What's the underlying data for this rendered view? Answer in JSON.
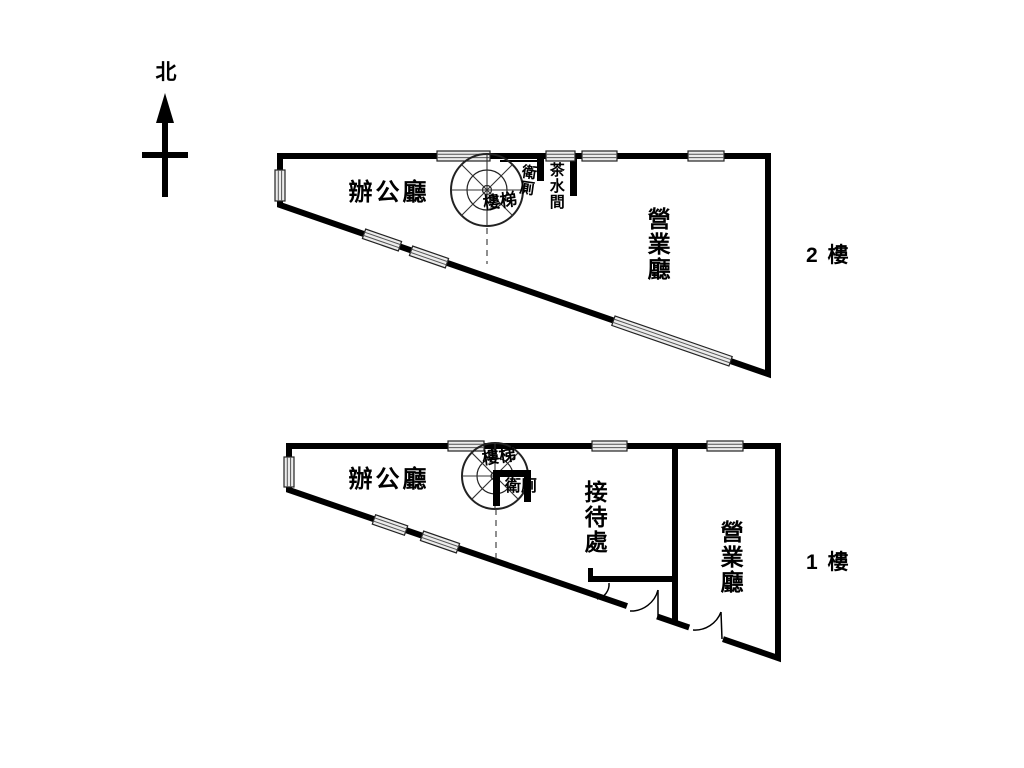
{
  "compass": {
    "north_label": "北"
  },
  "colors": {
    "line": "#000000",
    "window_fill": "#ececec",
    "background": "#ffffff"
  },
  "floors": [
    {
      "name": "second-floor",
      "floor_label": "2 樓",
      "rooms": {
        "office": "辦公廳",
        "toilet": "衛厠",
        "stairs": "樓梯",
        "pantry": "茶水間",
        "business_hall": "營業廳"
      }
    },
    {
      "name": "first-floor",
      "floor_label": "1 樓",
      "rooms": {
        "office": "辦公廳",
        "stairs": "樓梯",
        "toilet": "衛厠",
        "reception": "接待處",
        "business_hall": "營業廳"
      }
    }
  ]
}
